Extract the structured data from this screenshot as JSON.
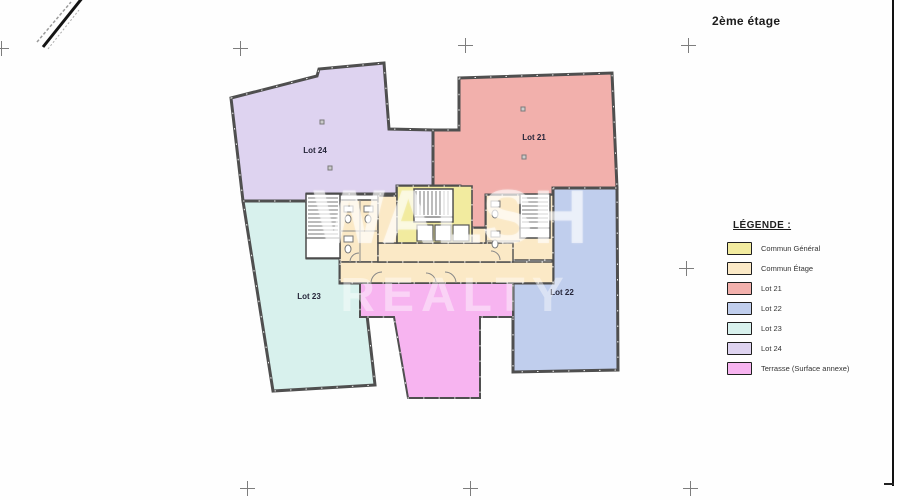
{
  "title": "2ème étage",
  "watermark": {
    "line1": "WALSH",
    "line2": "REALTY"
  },
  "legend": {
    "title": "LÉGENDE :",
    "items": [
      {
        "label": "Commun Général",
        "color": "#f2eb9f"
      },
      {
        "label": "Commun Étage",
        "color": "#fbe9c6"
      },
      {
        "label": "Lot 21",
        "color": "#f2b0ac"
      },
      {
        "label": "Lot 22",
        "color": "#c0ceed"
      },
      {
        "label": "Lot 23",
        "color": "#d8f1ed"
      },
      {
        "label": "Lot 24",
        "color": "#ded3f0"
      },
      {
        "label": "Terrasse (Surface annexe)",
        "color": "#f7b4f0"
      }
    ]
  },
  "plan": {
    "wall_color": "#4f4f4f",
    "regions": [
      {
        "name": "lot-24",
        "label": "Lot 24",
        "color": "#ded3f0",
        "stroke_w": 3,
        "points": "231,98 317,76 319,69 384,63 389,129 433,130 433,186 397,186 397,194 307,194 307,201 243,201",
        "label_x": 315,
        "label_y": 153
      },
      {
        "name": "lot-21",
        "label": "Lot 21",
        "color": "#f2b0ac",
        "stroke_w": 3,
        "points": "459,78 612,73 617,188 553,188 553,195 486,195 486,228 460,228 460,186 433,186 433,130 459,130",
        "label_x": 534,
        "label_y": 140
      },
      {
        "name": "lot-22",
        "label": "Lot 22",
        "color": "#c0ceed",
        "stroke_w": 3,
        "points": "553,188 617,188 618,370 513,372 513,283 553,283",
        "label_x": 562,
        "label_y": 295
      },
      {
        "name": "lot-23",
        "label": "Lot 23",
        "color": "#d8f1ed",
        "stroke_w": 3,
        "points": "243,201 307,201 307,258 340,258 340,283 362,283 367,315 375,385 273,391",
        "label_x": 309,
        "label_y": 299
      },
      {
        "name": "terrasse",
        "label": "",
        "color": "#f7b4f0",
        "stroke_w": 2,
        "points": "360,283 513,283 513,317 480,317 480,398 408,398 394,317 360,317"
      },
      {
        "name": "commun-etage-wing-left",
        "label": "",
        "color": "#fbe9c6",
        "stroke_w": 1.4,
        "points": "340,200 378,200 378,262 340,262"
      },
      {
        "name": "commun-etage-wing-right",
        "label": "",
        "color": "#fbe9c6",
        "stroke_w": 1.4,
        "points": "486,195 553,195 553,260 486,260"
      },
      {
        "name": "commun-etage-band",
        "label": "",
        "color": "#fbe9c6",
        "stroke_w": 1.4,
        "points": "340,262 553,262 553,283 340,283"
      },
      {
        "name": "commun-etage-strip-mid",
        "label": "",
        "color": "#fbe9c6",
        "stroke_w": 1.4,
        "points": "378,243 513,243 513,262 378,262"
      },
      {
        "name": "commun-etage-strip-left",
        "label": "",
        "color": "#fbe9c6",
        "stroke_w": 1.4,
        "points": "378,196 397,196 397,243 378,243"
      },
      {
        "name": "commun-etage-strip-right",
        "label": "",
        "color": "#fbe9c6",
        "stroke_w": 1.4,
        "points": "472,228 486,228 486,243 472,243"
      },
      {
        "name": "commun-general-core",
        "label": "",
        "color": "#f2eb9f",
        "stroke_w": 1.6,
        "points": "397,186 472,186 472,243 397,243"
      }
    ],
    "details": [
      {
        "type": "rect",
        "x": 414,
        "y": 189,
        "w": 39,
        "h": 33,
        "fill": "#ffffff",
        "stroke": "#4a4a4a",
        "sw": 1.5
      },
      {
        "type": "hatch",
        "x": 416,
        "y": 191,
        "w": 35,
        "h": 24,
        "dir": "v",
        "step": 4,
        "stroke": "#7a7a7a",
        "sw": 1
      },
      {
        "type": "line",
        "x1": 414,
        "y1": 217,
        "x2": 453,
        "y2": 217,
        "stroke": "#4a4a4a",
        "sw": 1
      },
      {
        "type": "rect",
        "x": 417,
        "y": 225,
        "w": 16,
        "h": 16,
        "fill": "#ffffff",
        "stroke": "#555555",
        "sw": 1.2
      },
      {
        "type": "rect",
        "x": 435,
        "y": 225,
        "w": 16,
        "h": 16,
        "fill": "#ffffff",
        "stroke": "#555555",
        "sw": 1.2
      },
      {
        "type": "rect",
        "x": 453,
        "y": 225,
        "w": 16,
        "h": 16,
        "fill": "#ffffff",
        "stroke": "#555555",
        "sw": 1.2
      },
      {
        "type": "rect",
        "x": 306,
        "y": 194,
        "w": 34,
        "h": 64,
        "fill": "#ffffff",
        "stroke": "#4a4a4a",
        "sw": 1.5
      },
      {
        "type": "hatch",
        "x": 308,
        "y": 198,
        "w": 30,
        "h": 36,
        "dir": "h",
        "step": 4,
        "stroke": "#7a7a7a",
        "sw": 1
      },
      {
        "type": "line",
        "x1": 306,
        "y1": 238,
        "x2": 340,
        "y2": 238,
        "stroke": "#4a4a4a",
        "sw": 1
      },
      {
        "type": "rect",
        "x": 520,
        "y": 194,
        "w": 30,
        "h": 44,
        "fill": "#ffffff",
        "stroke": "#4a4a4a",
        "sw": 1.5
      },
      {
        "type": "hatch",
        "x": 522,
        "y": 198,
        "w": 26,
        "h": 26,
        "dir": "h",
        "step": 4,
        "stroke": "#7a7a7a",
        "sw": 1
      },
      {
        "type": "line",
        "x1": 520,
        "y1": 228,
        "x2": 550,
        "y2": 228,
        "stroke": "#4a4a4a",
        "sw": 1
      },
      {
        "type": "line",
        "x1": 360,
        "y1": 200,
        "x2": 360,
        "y2": 262,
        "stroke": "#8a8a8a",
        "sw": 1
      },
      {
        "type": "line",
        "x1": 340,
        "y1": 231,
        "x2": 378,
        "y2": 231,
        "stroke": "#8a8a8a",
        "sw": 1
      },
      {
        "type": "line",
        "x1": 486,
        "y1": 241,
        "x2": 520,
        "y2": 241,
        "stroke": "#8a8a8a",
        "sw": 1
      },
      {
        "type": "rect",
        "x": 344,
        "y": 206,
        "w": 9,
        "h": 6,
        "fill": "#ffffff",
        "stroke": "#777777",
        "sw": 1
      },
      {
        "type": "ellipse",
        "cx": 348,
        "cy": 219,
        "rx": 3,
        "ry": 4,
        "fill": "#ffffff",
        "stroke": "#777777",
        "sw": 1
      },
      {
        "type": "rect",
        "x": 344,
        "y": 236,
        "w": 9,
        "h": 6,
        "fill": "#ffffff",
        "stroke": "#777777",
        "sw": 1
      },
      {
        "type": "ellipse",
        "cx": 348,
        "cy": 249,
        "rx": 3,
        "ry": 4,
        "fill": "#ffffff",
        "stroke": "#777777",
        "sw": 1
      },
      {
        "type": "rect",
        "x": 364,
        "y": 206,
        "w": 9,
        "h": 6,
        "fill": "#ffffff",
        "stroke": "#777777",
        "sw": 1
      },
      {
        "type": "ellipse",
        "cx": 368,
        "cy": 219,
        "rx": 3,
        "ry": 4,
        "fill": "#ffffff",
        "stroke": "#777777",
        "sw": 1
      },
      {
        "type": "rect",
        "x": 491,
        "y": 201,
        "w": 9,
        "h": 6,
        "fill": "#ffffff",
        "stroke": "#777777",
        "sw": 1
      },
      {
        "type": "ellipse",
        "cx": 495,
        "cy": 214,
        "rx": 3,
        "ry": 4,
        "fill": "#ffffff",
        "stroke": "#777777",
        "sw": 1
      },
      {
        "type": "rect",
        "x": 491,
        "y": 231,
        "w": 9,
        "h": 6,
        "fill": "#ffffff",
        "stroke": "#777777",
        "sw": 1
      },
      {
        "type": "ellipse",
        "cx": 495,
        "cy": 244,
        "rx": 3,
        "ry": 4,
        "fill": "#ffffff",
        "stroke": "#777777",
        "sw": 1
      },
      {
        "type": "path",
        "d": "M371,283 A11 11 0 0 1 382,272",
        "stroke": "#888888",
        "sw": 1
      },
      {
        "type": "path",
        "d": "M456,283 A11 11 0 0 0 445,272",
        "stroke": "#888888",
        "sw": 1
      },
      {
        "type": "path",
        "d": "M436,283 A10 10 0 0 0 426,273",
        "stroke": "#888888",
        "sw": 1
      },
      {
        "type": "path",
        "d": "M350,262 A9 9 0 0 1 359,253",
        "stroke": "#888888",
        "sw": 1
      },
      {
        "type": "path",
        "d": "M500,260 A9 9 0 0 0 491,251",
        "stroke": "#888888",
        "sw": 1
      }
    ],
    "column_markers": [
      {
        "x": 320,
        "y": 120
      },
      {
        "x": 328,
        "y": 166
      },
      {
        "x": 521,
        "y": 107
      },
      {
        "x": 522,
        "y": 155
      }
    ]
  },
  "crosshairs": [
    {
      "x": 1,
      "y": 48
    },
    {
      "x": 240,
      "y": 48
    },
    {
      "x": 465,
      "y": 45
    },
    {
      "x": 688,
      "y": 45
    },
    {
      "x": 686,
      "y": 268
    },
    {
      "x": 247,
      "y": 488
    },
    {
      "x": 470,
      "y": 488
    },
    {
      "x": 690,
      "y": 488
    }
  ]
}
